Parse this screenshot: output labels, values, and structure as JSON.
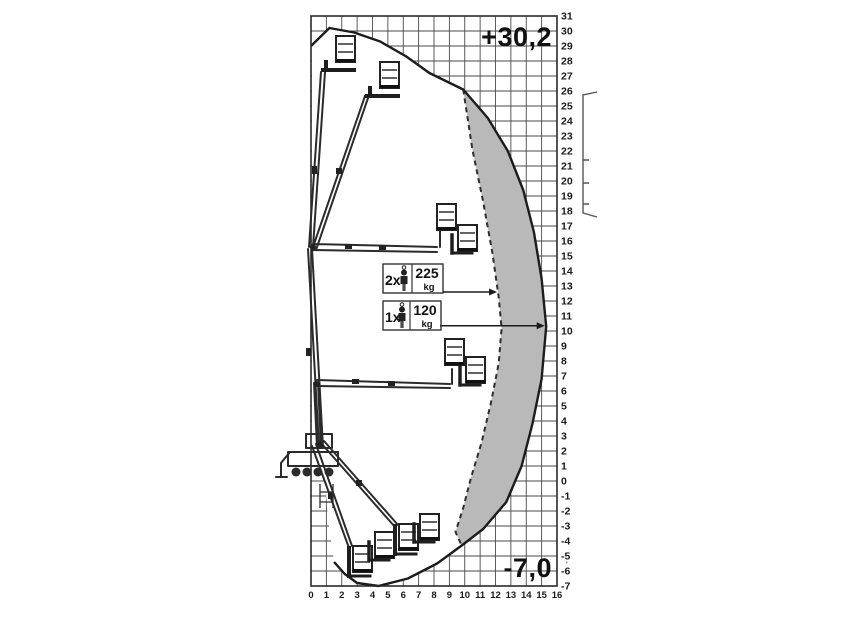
{
  "figure": {
    "max_height_label": "+30,2",
    "min_depth_label": "-7,0",
    "stray_mark": "'",
    "load_ratings": [
      {
        "count": "2x",
        "value": "225",
        "unit": "kg"
      },
      {
        "count": "1x",
        "value": "120",
        "unit": "kg"
      }
    ]
  },
  "chart_data": {
    "type": "area",
    "title": "Aerial work platform (telescopic boom lift) working envelope / outreach diagram",
    "xlabel": "",
    "ylabel": "",
    "x_axis": {
      "min": 0,
      "max": 16,
      "step": 1
    },
    "y_axis": {
      "min": -7,
      "max": 31,
      "step": 1
    },
    "grid": true,
    "max_platform_height": "+30,2",
    "max_depth": "-7,0",
    "series": [
      {
        "name": "envelope_1_person_120kg",
        "style": "solid",
        "points": [
          [
            0,
            29.0
          ],
          [
            1.2,
            30.2
          ],
          [
            2.8,
            29.9
          ],
          [
            4.5,
            29.3
          ],
          [
            6.2,
            28.3
          ],
          [
            7.7,
            27.2
          ],
          [
            9.9,
            26.1
          ],
          [
            11.5,
            24.2
          ],
          [
            12.8,
            22.0
          ],
          [
            13.8,
            19.4
          ],
          [
            14.5,
            16.6
          ],
          [
            15.0,
            13.5
          ],
          [
            15.3,
            10.3
          ],
          [
            15.0,
            6.8
          ],
          [
            14.4,
            3.8
          ],
          [
            13.7,
            1.0
          ],
          [
            12.7,
            -1.4
          ],
          [
            11.2,
            -3.2
          ],
          [
            9.8,
            -4.3
          ],
          [
            8.2,
            -5.5
          ],
          [
            6.3,
            -6.5
          ],
          [
            4.4,
            -7.0
          ],
          [
            3.0,
            -6.8
          ],
          [
            2.2,
            -6.2
          ],
          [
            1.5,
            -5.4
          ]
        ]
      },
      {
        "name": "envelope_2_persons_225kg",
        "style": "dashed",
        "points": [
          [
            9.9,
            26.1
          ],
          [
            10.5,
            22.1
          ],
          [
            11.2,
            18.6
          ],
          [
            11.8,
            15.2
          ],
          [
            12.2,
            12.3
          ],
          [
            12.4,
            10.2
          ],
          [
            12.2,
            7.8
          ],
          [
            11.7,
            5.2
          ],
          [
            11.1,
            2.6
          ],
          [
            10.4,
            0.2
          ],
          [
            9.9,
            -1.8
          ],
          [
            9.4,
            -3.4
          ],
          [
            9.8,
            -4.3
          ]
        ]
      }
    ],
    "close_left": [
      [
        1.1,
        -2.5
      ],
      [
        0.9,
        0.2
      ],
      [
        0.05,
        0.4
      ],
      [
        0.05,
        28.9
      ]
    ],
    "solid_junctions": [
      6,
      18
    ],
    "annotations": [
      {
        "label": "2x person 225 kg",
        "y": 12.6,
        "x_start": 8.6,
        "x_end": 12.1
      },
      {
        "label": "1x person 120 kg",
        "y": 10.35,
        "x_start": 8.4,
        "x_end": 15.2
      }
    ]
  }
}
